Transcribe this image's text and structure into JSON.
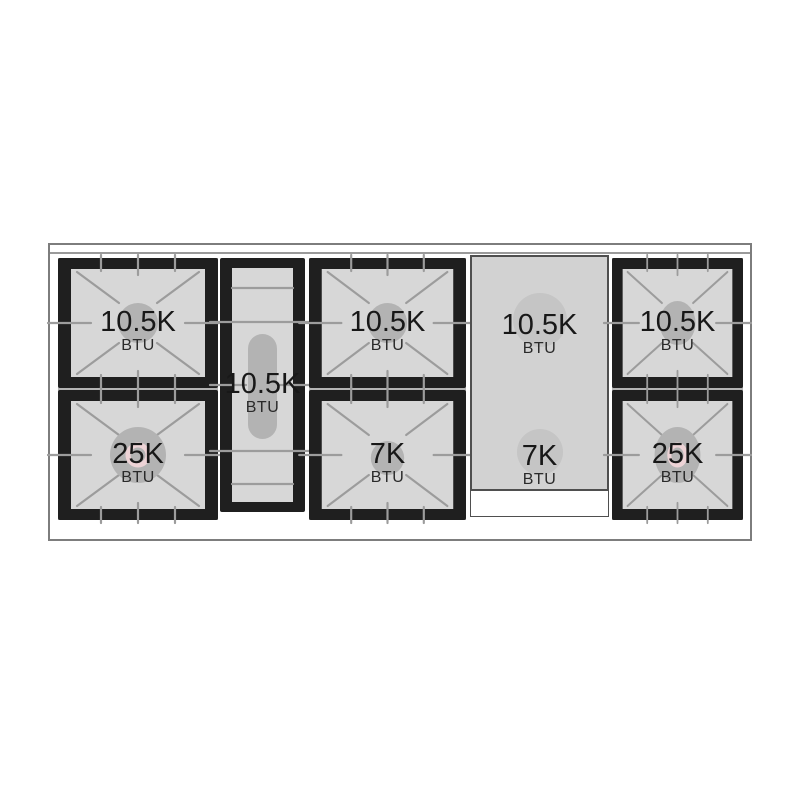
{
  "cooktop": {
    "burners": [
      {
        "id": "left-rear",
        "value": "10.5K",
        "unit": "BTU",
        "circle_color": "#b3b3b3"
      },
      {
        "id": "left-front",
        "value": "25K",
        "unit": "BTU",
        "circle_color": "#e1afb5",
        "ring_color": "#eed5d8"
      },
      {
        "id": "center-oval",
        "value": "10.5K",
        "unit": "BTU",
        "oval_color": "#b3b3b3"
      },
      {
        "id": "middle-rear",
        "value": "10.5K",
        "unit": "BTU",
        "circle_color": "#b3b3b3"
      },
      {
        "id": "middle-front",
        "value": "7K",
        "unit": "BTU",
        "circle_color": "#b9b9b9"
      },
      {
        "id": "griddle-rear",
        "value": "10.5K",
        "unit": "BTU",
        "circle_color": "#c5c5c5"
      },
      {
        "id": "griddle-front",
        "value": "7K",
        "unit": "BTU",
        "circle_color": "#c5c5c5"
      },
      {
        "id": "right-rear",
        "value": "10.5K",
        "unit": "BTU",
        "circle_color": "#b3b3b3"
      },
      {
        "id": "right-front",
        "value": "25K",
        "unit": "BTU",
        "circle_color": "#e1afb5",
        "ring_color": "#eed5d8"
      }
    ]
  },
  "colors": {
    "frame": "#1f1f1f",
    "surface": "#d7d7d7",
    "grate_line": "#9c9c9c",
    "griddle": "#d2d2d2",
    "outline": "#7d7d7d",
    "text": "#181818",
    "burner_gray": "#b3b3b3",
    "burner_pink": "#e1afb5",
    "page_bg": "#ffffff"
  }
}
